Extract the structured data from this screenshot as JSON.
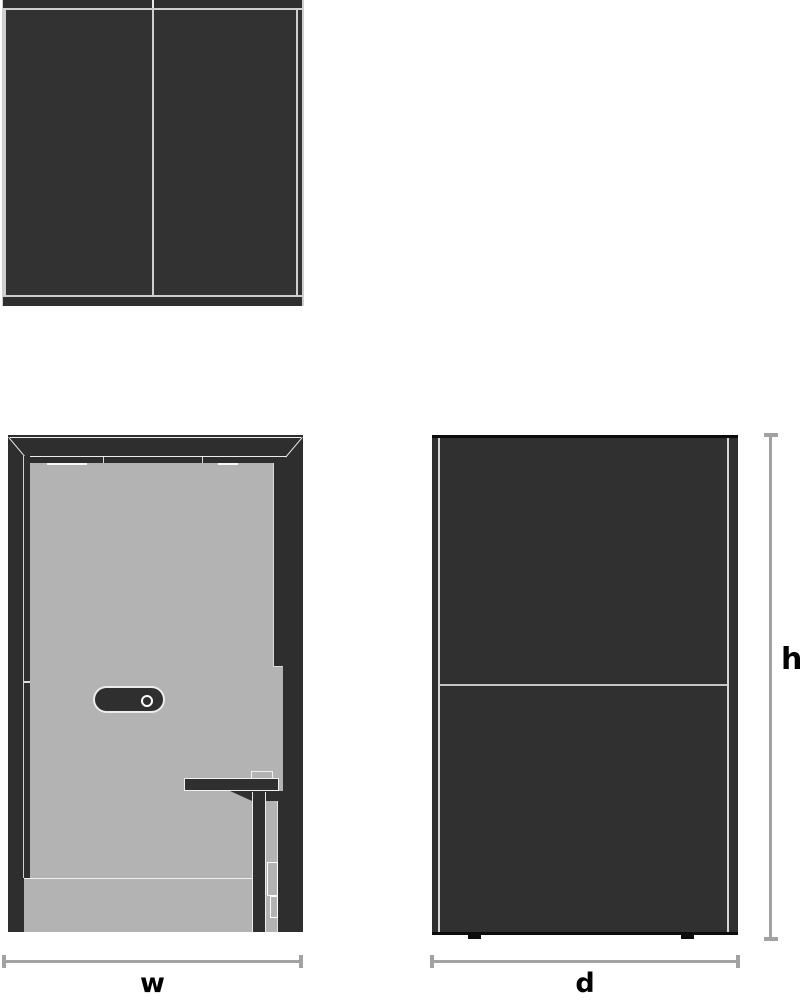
{
  "diagram": {
    "views": {
      "top_view": "top-plan-view",
      "front_view": "front-elevation-view",
      "side_view": "side-elevation-view"
    },
    "dimension_labels": {
      "width": "w",
      "depth": "d",
      "height": "h"
    },
    "colors": {
      "panel_dark": "#323232",
      "frame_dark": "#2e2e2e",
      "edge_black": "#0c0c0c",
      "door_gray": "#b3b3b3",
      "outline_light": "#ececec",
      "dimension_line": "#a2a2a2",
      "label_text": "#000000",
      "background": "#ffffff"
    }
  }
}
